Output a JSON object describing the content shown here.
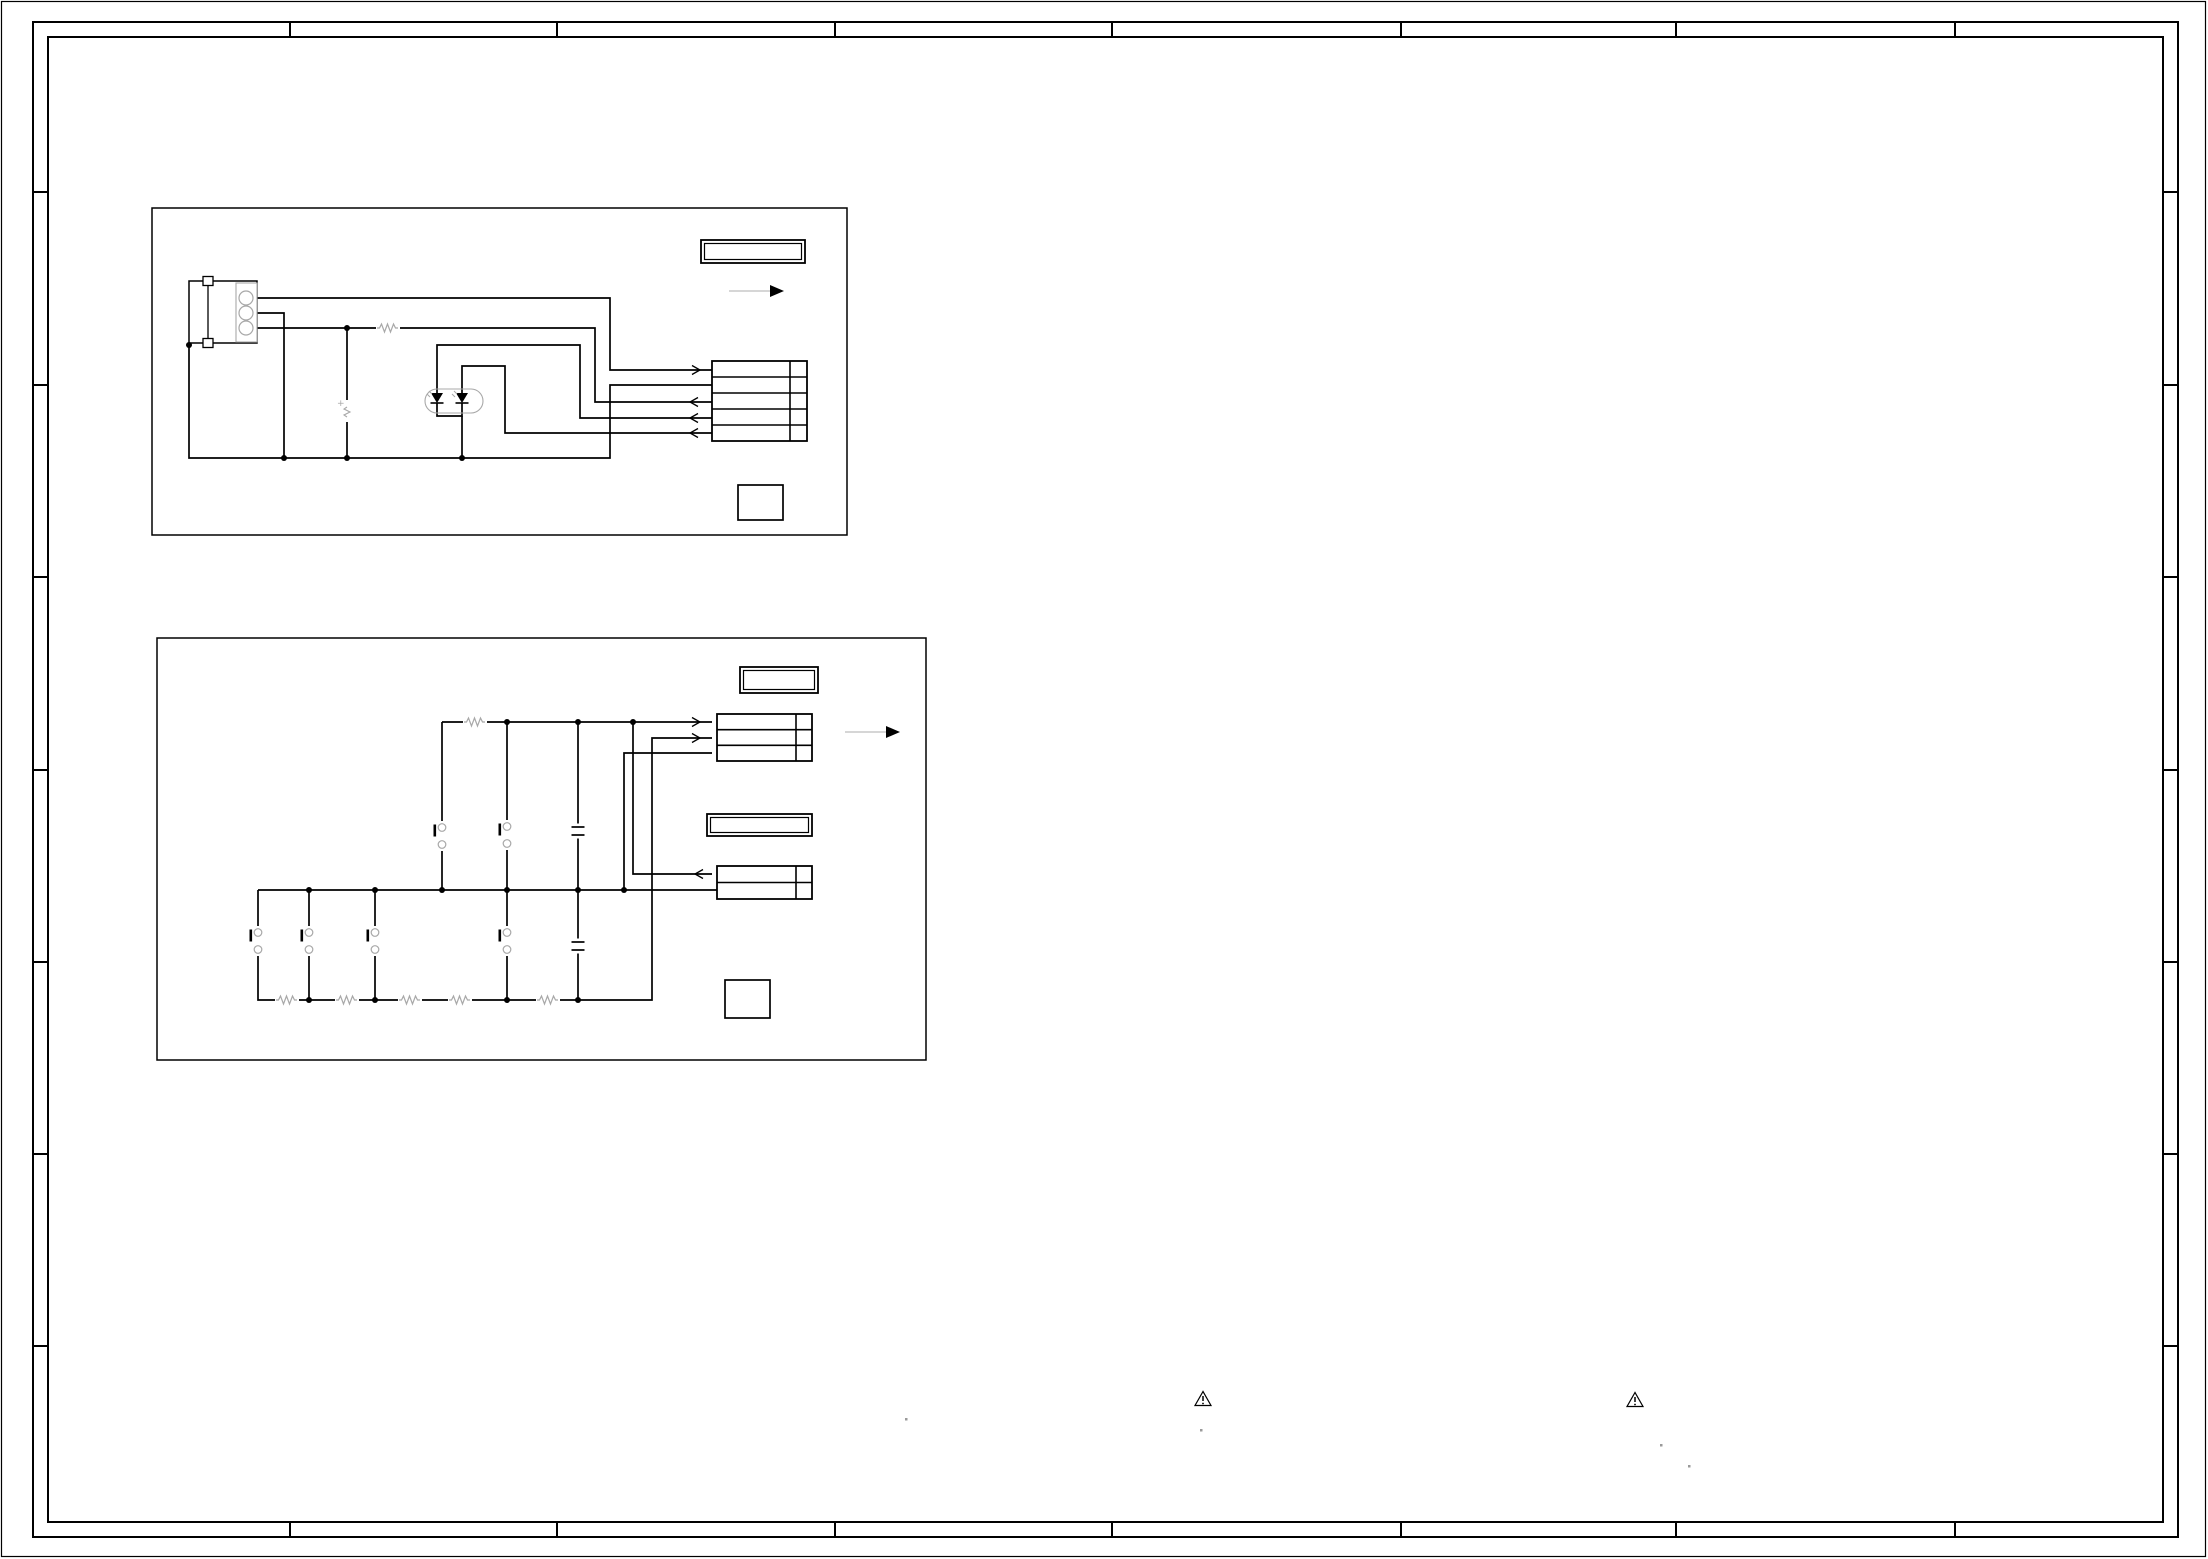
{
  "page": {
    "width": 2208,
    "height": 1559,
    "bg": "#ffffff"
  },
  "colors": {
    "line": "#000000",
    "component": "#a8a8a8",
    "flow_line": "#c9c9c9",
    "speck": "#9a9a9a"
  },
  "frame": {
    "page_border": [
      1.5,
      1.5,
      2204,
      1555
    ],
    "outer": [
      33,
      22,
      2145,
      1515
    ],
    "inner": [
      48,
      37,
      2115,
      1485
    ],
    "top_ticks": [
      290,
      557,
      835,
      1112,
      1401,
      1676,
      1955
    ],
    "side_ticks": [
      192,
      385,
      577,
      770,
      962,
      1154,
      1346
    ]
  },
  "blocks": [
    {
      "name": "circuit-block-1",
      "rect": [
        152,
        208,
        695,
        327
      ]
    },
    {
      "name": "circuit-block-2",
      "rect": [
        157,
        638,
        769,
        422
      ]
    }
  ],
  "title_boxes": [
    {
      "name": "title-box-1",
      "rect": [
        701,
        240,
        104,
        23
      ]
    },
    {
      "name": "title-box-2",
      "rect": [
        740,
        667,
        78,
        26
      ]
    },
    {
      "name": "label-box",
      "rect": [
        707,
        814,
        105,
        22
      ]
    }
  ],
  "flow_arrows": [
    {
      "x1": 729,
      "x2": 770,
      "tip": 784,
      "y": 291
    },
    {
      "x1": 845,
      "x2": 886,
      "tip": 900,
      "y": 732
    }
  ],
  "connector_tables": [
    {
      "name": "connector-table-5pin",
      "x": 712,
      "y": 361,
      "w": 95,
      "h": 80,
      "rows": 5,
      "div": 17
    },
    {
      "name": "connector-table-3pin",
      "x": 717,
      "y": 714,
      "w": 95,
      "h": 47,
      "rows": 3,
      "div": 16
    },
    {
      "name": "connector-table-2pin",
      "x": 717,
      "y": 866,
      "w": 95,
      "h": 33,
      "rows": 2,
      "div": 16
    }
  ],
  "squares": [
    [
      738,
      485,
      45,
      35
    ],
    [
      725,
      980,
      45,
      38
    ]
  ],
  "wires": [
    [
      [
        253,
        298
      ],
      [
        610,
        298
      ],
      [
        610,
        370
      ],
      [
        712,
        370
      ]
    ],
    [
      [
        253,
        313
      ],
      [
        284,
        313
      ],
      [
        284,
        458
      ]
    ],
    [
      [
        253,
        328
      ],
      [
        595,
        328
      ],
      [
        595,
        402
      ],
      [
        712,
        402
      ]
    ],
    [
      [
        189,
        343
      ],
      [
        189,
        458
      ],
      [
        610,
        458
      ],
      [
        610,
        385
      ],
      [
        712,
        385
      ]
    ],
    [
      [
        347,
        328
      ],
      [
        347,
        458
      ]
    ],
    [
      [
        437,
        393
      ],
      [
        437,
        345
      ],
      [
        580,
        345
      ],
      [
        580,
        418
      ],
      [
        712,
        418
      ]
    ],
    [
      [
        462,
        393
      ],
      [
        462,
        366
      ],
      [
        505,
        366
      ],
      [
        505,
        433
      ],
      [
        712,
        433
      ]
    ],
    [
      [
        437,
        403
      ],
      [
        437,
        416
      ],
      [
        462,
        416
      ],
      [
        462,
        403
      ]
    ],
    [
      [
        462,
        416
      ],
      [
        462,
        458
      ]
    ],
    [
      [
        442,
        722
      ],
      [
        712,
        722
      ]
    ],
    [
      [
        442,
        722
      ],
      [
        442,
        890
      ]
    ],
    [
      [
        507,
        722
      ],
      [
        507,
        1000
      ]
    ],
    [
      [
        578,
        722
      ],
      [
        578,
        1000
      ]
    ],
    [
      [
        633,
        722
      ],
      [
        633,
        874
      ],
      [
        712,
        874
      ]
    ],
    [
      [
        712,
        753
      ],
      [
        624,
        753
      ],
      [
        624,
        890
      ]
    ],
    [
      [
        258,
        890
      ],
      [
        717,
        890
      ]
    ],
    [
      [
        258,
        890
      ],
      [
        258,
        1000
      ],
      [
        652,
        1000
      ],
      [
        652,
        738
      ],
      [
        712,
        738
      ]
    ],
    [
      [
        309,
        890
      ],
      [
        309,
        1000
      ]
    ],
    [
      [
        375,
        890
      ],
      [
        375,
        1000
      ]
    ]
  ],
  "junctions": [
    [
      189,
      345
    ],
    [
      284,
      458
    ],
    [
      347,
      328
    ],
    [
      347,
      458
    ],
    [
      462,
      458
    ],
    [
      507,
      722
    ],
    [
      578,
      722
    ],
    [
      633,
      722
    ],
    [
      309,
      890
    ],
    [
      375,
      890
    ],
    [
      442,
      890
    ],
    [
      507,
      890
    ],
    [
      578,
      890
    ],
    [
      624,
      890
    ],
    [
      309,
      1000
    ],
    [
      375,
      1000
    ],
    [
      507,
      1000
    ],
    [
      578,
      1000
    ]
  ],
  "resistors": [
    [
      388,
      328
    ],
    [
      475,
      722
    ],
    [
      287,
      1000
    ],
    [
      347,
      1000
    ],
    [
      410,
      1000
    ],
    [
      460,
      1000
    ],
    [
      548,
      1000
    ]
  ],
  "switches": [
    [
      442,
      836
    ],
    [
      507,
      835
    ],
    [
      258,
      941
    ],
    [
      309,
      941
    ],
    [
      375,
      941
    ],
    [
      507,
      941
    ]
  ],
  "capacitors": [
    [
      578,
      831
    ],
    [
      578,
      946
    ]
  ],
  "wire_arrows": [
    {
      "x": 700,
      "y": 370,
      "dir": "right"
    },
    {
      "x": 690,
      "y": 402,
      "dir": "left"
    },
    {
      "x": 690,
      "y": 418,
      "dir": "left"
    },
    {
      "x": 690,
      "y": 433,
      "dir": "left"
    },
    {
      "x": 700,
      "y": 722,
      "dir": "right"
    },
    {
      "x": 700,
      "y": 738,
      "dir": "right"
    },
    {
      "x": 695,
      "y": 874,
      "dir": "left"
    }
  ],
  "left_connector": {
    "bracket": [
      189,
      281,
      68,
      62
    ],
    "pin_box": [
      236,
      283,
      21,
      59
    ],
    "squares": [
      [
        203,
        276.5,
        10,
        9
      ],
      [
        203,
        338.5,
        10,
        9
      ]
    ],
    "inner_line_x": 208,
    "pin_cx": 246,
    "pin_cys": [
      298,
      313,
      328
    ],
    "pin_r": 7
  },
  "led_package": {
    "rect": [
      425,
      389,
      58,
      24
    ],
    "led_xs": [
      437,
      462
    ],
    "tri_top": 393,
    "tri_bot": 403
  },
  "buzzer": {
    "x": 347,
    "y": 411,
    "plus_label": "+"
  },
  "warning_icons": [
    [
      1203,
      1399
    ],
    [
      1635,
      1400
    ]
  ],
  "specks": [
    [
      905,
      1418
    ],
    [
      1200,
      1429
    ],
    [
      1660,
      1444
    ],
    [
      1688,
      1465
    ]
  ]
}
